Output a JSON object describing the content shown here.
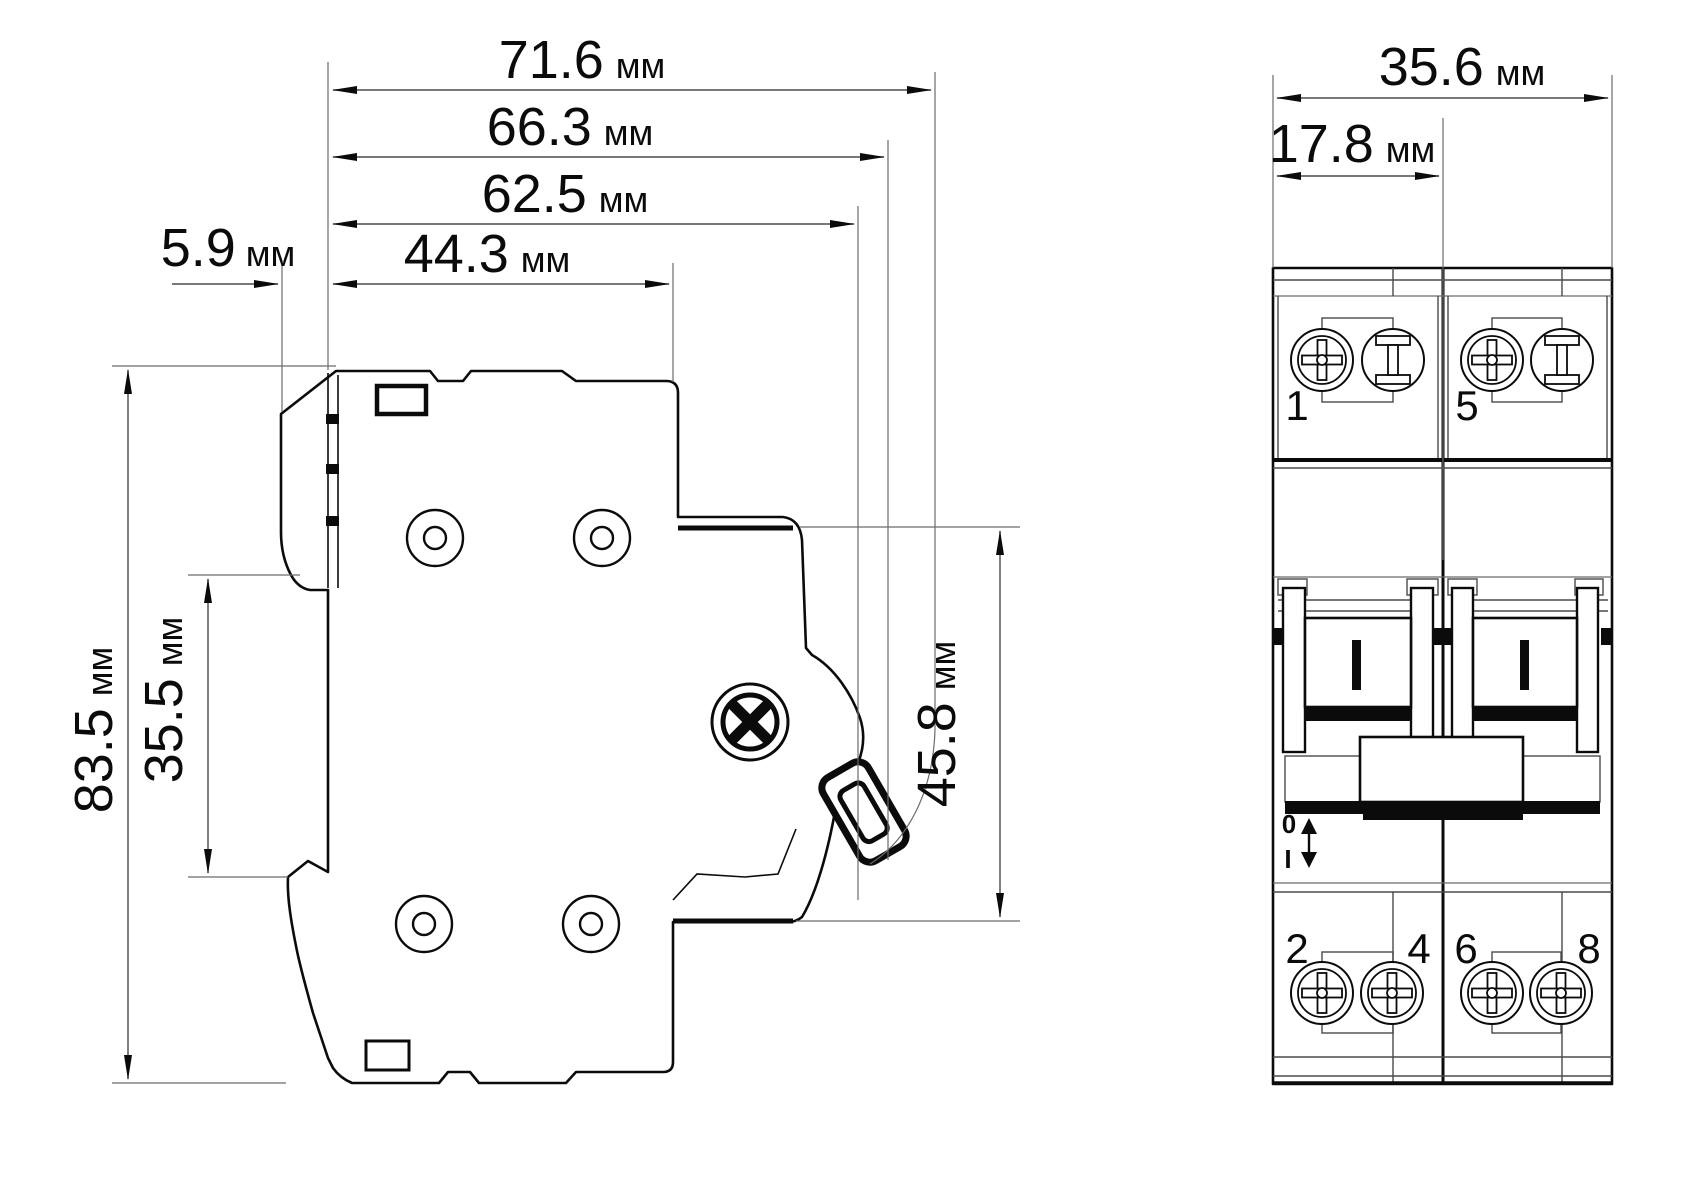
{
  "drawing": {
    "title": "circuit-breaker-dimension-drawing",
    "background_color": "#ffffff",
    "line_color": "#0b0b0b",
    "unit": "мм"
  },
  "dimensions": {
    "side_overall_depth": {
      "value": "71.6",
      "unit": "мм"
    },
    "side_depth_to_lever": {
      "value": "66.3",
      "unit": "мм"
    },
    "side_depth_to_face": {
      "value": "62.5",
      "unit": "мм"
    },
    "side_depth_body": {
      "value": "44.3",
      "unit": "мм"
    },
    "side_din_offset": {
      "value": "5.9",
      "unit": "мм"
    },
    "side_height": {
      "value": "83.5",
      "unit": "мм"
    },
    "side_din_gap": {
      "value": "35.5",
      "unit": "мм"
    },
    "side_front_height": {
      "value": "45.8",
      "unit": "мм"
    },
    "front_width": {
      "value": "35.6",
      "unit": "мм"
    },
    "front_pole_width": {
      "value": "17.8",
      "unit": "мм"
    }
  },
  "front_view": {
    "top_terminal_labels": [
      "1",
      "5"
    ],
    "bottom_terminal_labels": [
      "2",
      "4",
      "6",
      "8"
    ],
    "switch_position_off": "0",
    "switch_position_on": "I"
  }
}
